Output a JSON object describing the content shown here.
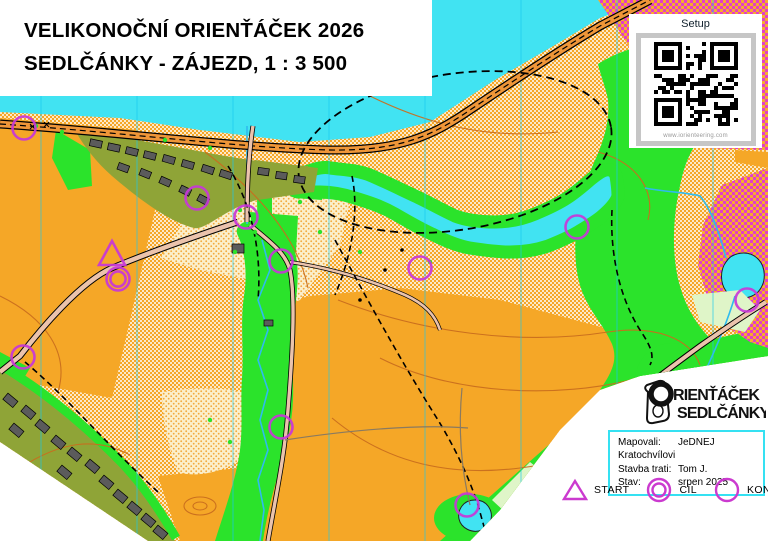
{
  "title": {
    "line1": "VELIKONOČNÍ ORIENŤÁČEK 2026",
    "line2": "SEDLČÁNKY - ZÁJEZD, 1 : 3 500"
  },
  "qr_panel": {
    "label": "Setup",
    "caption": "www.iorienteering.com"
  },
  "logo": {
    "initial": "O",
    "line1": "RIENŤÁČEK",
    "line2": "SEDLČÁNKY"
  },
  "credits": {
    "rows": [
      {
        "label": "Mapovali:",
        "value": "JeDNEJ Kratochvílovi"
      },
      {
        "label": "Stavba trati:",
        "value": "Tom J."
      },
      {
        "label": "Stav:",
        "value": "srpen 2025"
      }
    ]
  },
  "legend": {
    "items": [
      {
        "symbol": "start-triangle",
        "label": "START"
      },
      {
        "symbol": "finish-double-circle",
        "label": "CÍL"
      },
      {
        "symbol": "control-circle",
        "label": "KONTROLA"
      }
    ]
  },
  "map": {
    "scale_text": "1 : 3 500",
    "course_color": "#C837D8",
    "start": {
      "x": 112,
      "y": 255
    },
    "finish": {
      "x": 118,
      "y": 279
    },
    "controls": [
      [
        24,
        128
      ],
      [
        197,
        198
      ],
      [
        246,
        217
      ],
      [
        281,
        261
      ],
      [
        420,
        268
      ],
      [
        577,
        227
      ],
      [
        747,
        300
      ],
      [
        23,
        357
      ],
      [
        281,
        427
      ],
      [
        467,
        505
      ]
    ],
    "north_line_xs": [
      41,
      137,
      233,
      329,
      425,
      521,
      617,
      713
    ]
  },
  "colors": {
    "water": "#41E3F2",
    "open_orange": "#F5A727",
    "vegetation_green": "#2BE32B",
    "olive_settlement": "#8FA437",
    "pale_green": "#DFF5C8",
    "out_of_bounds_magenta": "#E23FC8",
    "course_magenta": "#C837D8",
    "contour_brown": "#C96E1E",
    "road_fill": "#EBC3AC",
    "building_gray": "#5B5B5B",
    "credits_border_cyan": "#35E1F2"
  }
}
